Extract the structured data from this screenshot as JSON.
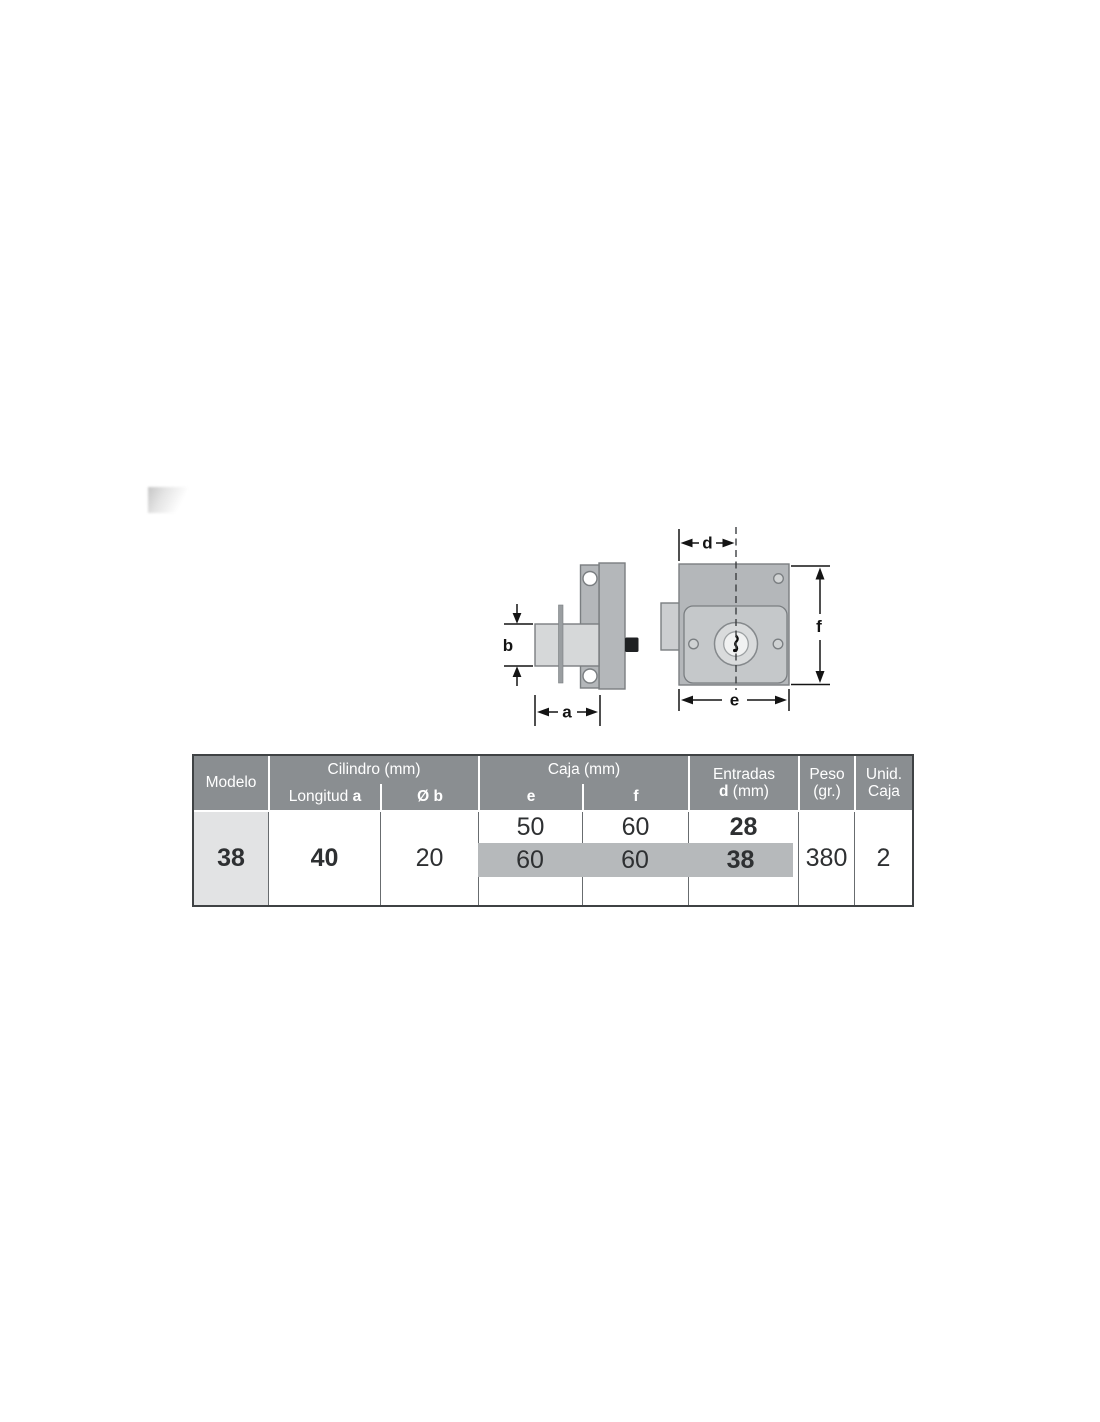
{
  "diagram": {
    "name": "lock technical drawing, side view and front view",
    "dimension_labels": {
      "a": "a",
      "b": "b",
      "d": "d",
      "e": "e",
      "f": "f"
    }
  },
  "table": {
    "header": {
      "modelo": "Modelo",
      "cilindro_group": "Cilindro (mm)",
      "longitud_label": "Longitud ",
      "longitud_var": "a",
      "diam_b": "Ø b",
      "caja_group": "Caja (mm)",
      "e": "e",
      "f": "f",
      "entradas_line1": "Entradas",
      "entradas_var": "d",
      "entradas_unit": " (mm)",
      "peso_line1": "Peso",
      "peso_line2": "(gr.)",
      "unid_line1": "Unid.",
      "unid_line2": "Caja"
    },
    "body": {
      "modelo": "38",
      "longitud_a": "40",
      "diam_b": "20",
      "rows": [
        {
          "e": "50",
          "f": "60",
          "d": "28"
        },
        {
          "e": "60",
          "f": "60",
          "d": "38"
        },
        {
          "e": "",
          "f": "",
          "d": ""
        }
      ],
      "peso": "380",
      "unid_caja": "2"
    }
  },
  "colors": {
    "header_bg": "#8a8e91",
    "header_text": "#ffffff",
    "band_bg": "#b6b9bb",
    "model_cell_bg": "#e2e3e4",
    "table_border": "#3f4244",
    "column_line": "#686c6f",
    "part_gray": "#b4b7ba",
    "panel_gray": "#c5c8ca",
    "cylinder_gray": "#d6d8d9",
    "dimension_ink": "#141414"
  }
}
